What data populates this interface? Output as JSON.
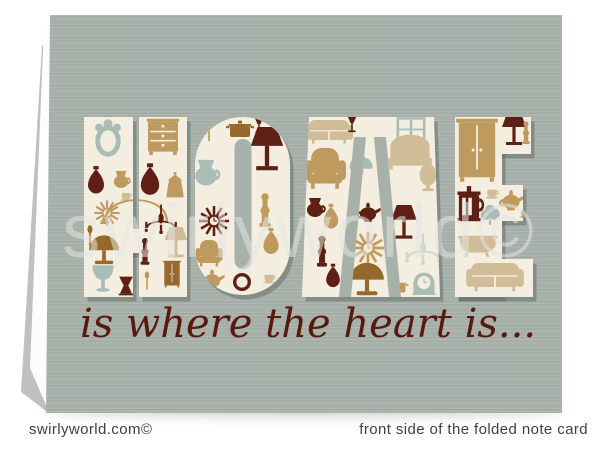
{
  "page": {
    "background": "#ffffff"
  },
  "card": {
    "word": "HOME",
    "letters": [
      "H",
      "O",
      "M",
      "E"
    ],
    "tagline": "is where the heart is...",
    "tagline_color": "#5a190e",
    "watermark": "swirlyworld©",
    "watermark_color": "#e5e5e2",
    "color": "#a7b1aa",
    "letter_fill": "#f4eee0"
  },
  "footer": {
    "left": "swirlyworld.com©",
    "right": "front side of the folded note card",
    "color": "#443d3e"
  },
  "palette": {
    "card": "#a7b1aa",
    "cream": "#f4eee0",
    "maroon": "#5e2014",
    "gold": "#bf9a5e",
    "tan": "#d0bc96",
    "sage": "#a9bdb6",
    "brown": "#96682c",
    "pale": "#ccd6d0"
  },
  "icons": [
    {
      "icon": "mirror",
      "color": "sage",
      "x": 108,
      "y": 141,
      "s": 1.5
    },
    {
      "icon": "vase",
      "color": "maroon",
      "x": 96,
      "y": 184,
      "s": 1.0
    },
    {
      "icon": "jug",
      "color": "gold",
      "x": 121,
      "y": 179,
      "s": 0.9
    },
    {
      "icon": "sunburst",
      "color": "gold",
      "x": 107,
      "y": 213,
      "s": 1.05
    },
    {
      "icon": "cup",
      "color": "tan",
      "x": 126,
      "y": 196,
      "s": 0.75
    },
    {
      "icon": "spoon",
      "color": "brown",
      "x": 90,
      "y": 236,
      "s": 0.9
    },
    {
      "icon": "domelamp",
      "color": "brown",
      "x": 104,
      "y": 248,
      "s": 1.15
    },
    {
      "icon": "tulip",
      "color": "sage",
      "x": 103,
      "y": 280,
      "s": 1.05
    },
    {
      "icon": "stool",
      "color": "maroon",
      "x": 126,
      "y": 286,
      "s": 0.85
    },
    {
      "icon": "arco",
      "color": "gold",
      "x": 136,
      "y": 207,
      "s": 1.0
    },
    {
      "icon": "chest",
      "color": "gold",
      "x": 163,
      "y": 136,
      "s": 1.15
    },
    {
      "icon": "vase",
      "color": "maroon",
      "x": 150,
      "y": 184,
      "s": 1.15
    },
    {
      "icon": "lantern",
      "color": "gold",
      "x": 175,
      "y": 187,
      "s": 1.0
    },
    {
      "icon": "chandelier",
      "color": "maroon",
      "x": 161,
      "y": 223,
      "s": 1.15
    },
    {
      "icon": "shadelamp",
      "color": "tan",
      "x": 176,
      "y": 246,
      "s": 0.95
    },
    {
      "icon": "column",
      "color": "maroon",
      "x": 145,
      "y": 253,
      "s": 1.0
    },
    {
      "icon": "wardrobe",
      "color": "brown",
      "x": 172,
      "y": 274,
      "s": 0.55
    },
    {
      "icon": "spoon",
      "color": "gold",
      "x": 147,
      "y": 281,
      "s": 0.8
    },
    {
      "icon": "pot",
      "color": "brown",
      "x": 240,
      "y": 131,
      "s": 1.0
    },
    {
      "icon": "spoon",
      "color": "gold",
      "x": 209,
      "y": 132,
      "s": 0.85
    },
    {
      "icon": "glass",
      "color": "maroon",
      "x": 259,
      "y": 128,
      "s": 0.8
    },
    {
      "icon": "jug",
      "color": "sage",
      "x": 206,
      "y": 172,
      "s": 1.35
    },
    {
      "icon": "shadelamp",
      "color": "maroon",
      "x": 267,
      "y": 154,
      "s": 1.35
    },
    {
      "icon": "sunburst",
      "color": "maroon",
      "x": 214,
      "y": 221,
      "s": 1.25
    },
    {
      "icon": "column",
      "color": "gold",
      "x": 265,
      "y": 212,
      "s": 1.25
    },
    {
      "icon": "armchair",
      "color": "gold",
      "x": 209,
      "y": 253,
      "s": 1.0
    },
    {
      "icon": "vase",
      "color": "gold",
      "x": 271,
      "y": 245,
      "s": 0.95
    },
    {
      "icon": "teapot",
      "color": "gold",
      "x": 212,
      "y": 281,
      "s": 0.9
    },
    {
      "icon": "plate",
      "color": "maroon",
      "x": 242,
      "y": 282,
      "s": 1.0
    },
    {
      "icon": "cup",
      "color": "tan",
      "x": 269,
      "y": 278,
      "s": 0.8
    },
    {
      "icon": "sofa",
      "color": "tan",
      "x": 329,
      "y": 130,
      "s": 1.0
    },
    {
      "icon": "glass",
      "color": "maroon",
      "x": 352,
      "y": 127,
      "s": 0.85
    },
    {
      "icon": "window",
      "color": "sage",
      "x": 411,
      "y": 129,
      "s": 0.85
    },
    {
      "icon": "armchair",
      "color": "gold",
      "x": 325,
      "y": 168,
      "s": 1.55
    },
    {
      "icon": "bed",
      "color": "tan",
      "x": 410,
      "y": 153,
      "s": 1.15
    },
    {
      "icon": "egglamp",
      "color": "tan",
      "x": 428,
      "y": 180,
      "s": 1.05
    },
    {
      "icon": "pendant",
      "color": "sage",
      "x": 361,
      "y": 167,
      "s": 1.15
    },
    {
      "icon": "jug",
      "color": "maroon",
      "x": 315,
      "y": 207,
      "s": 1.0
    },
    {
      "icon": "vase",
      "color": "gold",
      "x": 331,
      "y": 220,
      "s": 0.9
    },
    {
      "icon": "teapot",
      "color": "maroon",
      "x": 368,
      "y": 214,
      "s": 0.9
    },
    {
      "icon": "shadelamp",
      "color": "maroon",
      "x": 404,
      "y": 226,
      "s": 1.05
    },
    {
      "icon": "sunburst",
      "color": "gold",
      "x": 368,
      "y": 248,
      "s": 1.35
    },
    {
      "icon": "column",
      "color": "maroon",
      "x": 322,
      "y": 253,
      "s": 1.15
    },
    {
      "icon": "chandelier",
      "color": "pale",
      "x": 423,
      "y": 253,
      "s": 1.25
    },
    {
      "icon": "domelamp",
      "color": "brown",
      "x": 367,
      "y": 277,
      "s": 1.3
    },
    {
      "icon": "vase",
      "color": "maroon",
      "x": 333,
      "y": 279,
      "s": 0.85
    },
    {
      "icon": "mclock",
      "color": "sage",
      "x": 424,
      "y": 283,
      "s": 1.05
    },
    {
      "icon": "pot",
      "color": "gold",
      "x": 398,
      "y": 288,
      "s": 0.75
    },
    {
      "icon": "wardrobe",
      "color": "gold",
      "x": 477,
      "y": 150,
      "s": 1.3
    },
    {
      "icon": "shadelamp",
      "color": "maroon",
      "x": 514,
      "y": 133,
      "s": 1.0
    },
    {
      "icon": "column",
      "color": "gold",
      "x": 526,
      "y": 134,
      "s": 0.85
    },
    {
      "icon": "press",
      "color": "maroon",
      "x": 469,
      "y": 205,
      "s": 1.35
    },
    {
      "icon": "cup",
      "color": "tan",
      "x": 492,
      "y": 193,
      "s": 0.85
    },
    {
      "icon": "puff",
      "color": "sage",
      "x": 490,
      "y": 214,
      "s": 1.1
    },
    {
      "icon": "teapot",
      "color": "gold",
      "x": 511,
      "y": 202,
      "s": 0.95
    },
    {
      "icon": "cup",
      "color": "gold",
      "x": 525,
      "y": 213,
      "s": 0.7
    },
    {
      "icon": "tub",
      "color": "tan",
      "x": 478,
      "y": 242,
      "s": 1.05
    },
    {
      "icon": "sofa",
      "color": "tan",
      "x": 495,
      "y": 275,
      "s": 1.2
    }
  ]
}
